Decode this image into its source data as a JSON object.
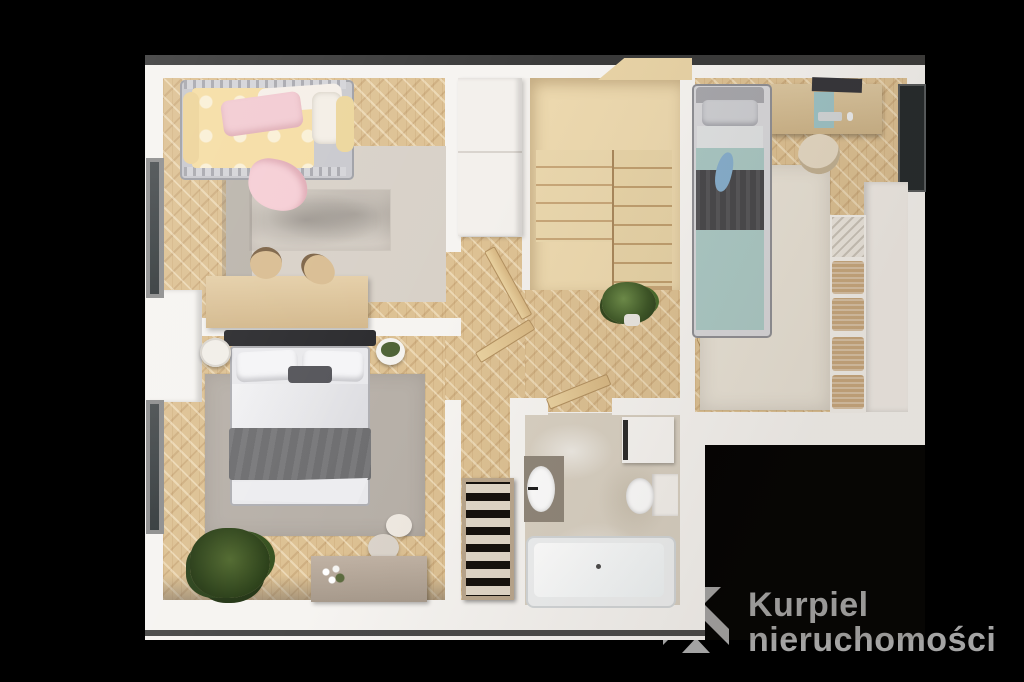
{
  "brand": {
    "name_line1": "Kurpiel",
    "name_line2": "nieruchomości"
  },
  "logo": {
    "icon": "kurpiel-monogram-icon",
    "text_color": "#a4a4a4",
    "icon_color": "#a3a3a3"
  },
  "scene": {
    "type": "3d-floor-plan-render",
    "background_color": "#000000",
    "wall_color": "#f6f4f1",
    "wood_floor_color": "#ddc193",
    "stairs_wood_color": "#ecd8ae",
    "bathroom_tile_color": "#d8d0c2",
    "rug_gray_color": "#b7b0a8",
    "accent_teal_color": "#a9c7c3",
    "blanket_dark_color": "#48484b",
    "child_bedding_yellow": "#f5dda4",
    "child_pillow_pink": "#f2cbd2"
  }
}
